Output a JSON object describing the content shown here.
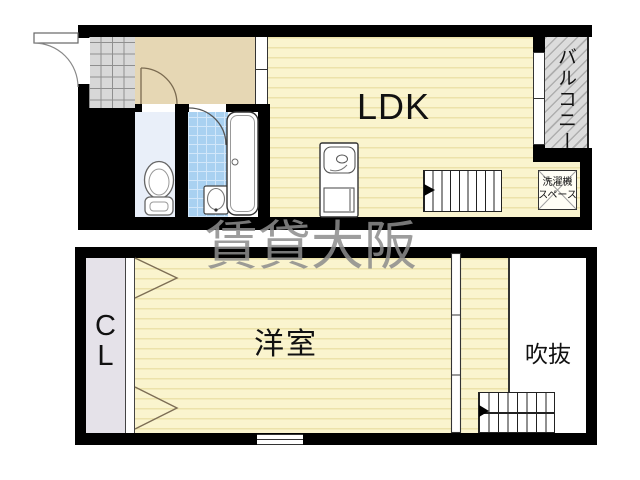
{
  "title": "2-story maisonette floor plan",
  "watermark": {
    "text": "賃貸大阪",
    "color": "#8c8c8c"
  },
  "upper_floor": {
    "rooms": {
      "ldk": {
        "label": "LDK"
      },
      "balcony": {
        "label": "バルコニー"
      },
      "laundry_space": {
        "label": "洗濯機\nスペース"
      }
    },
    "fixtures": [
      "entrance-door",
      "entry-tile",
      "toilet",
      "washbasin",
      "bathtub",
      "kitchen-sink",
      "staircase"
    ]
  },
  "lower_floor": {
    "rooms": {
      "closet": {
        "label": "C\nL"
      },
      "western_room": {
        "label": "洋室"
      },
      "void": {
        "label": "吹抜"
      }
    },
    "fixtures": [
      "folding-closet-doors",
      "sliding-partition",
      "staircase",
      "window"
    ]
  },
  "colors": {
    "wall": "#000000",
    "floor_yellow": "#faf4ce",
    "floor_stripe": "#ece2aa",
    "hall_beige": "#e6d7b4",
    "entry_tile_gray": "#d8d8d8",
    "bath_tile_blue": "#a9d1f1",
    "toilet_floor": "#e9eff9",
    "closet_gray": "#e5e2e9",
    "balcony_gray": "#dcdcdc",
    "watermark_gray": "#8c8c8c"
  }
}
